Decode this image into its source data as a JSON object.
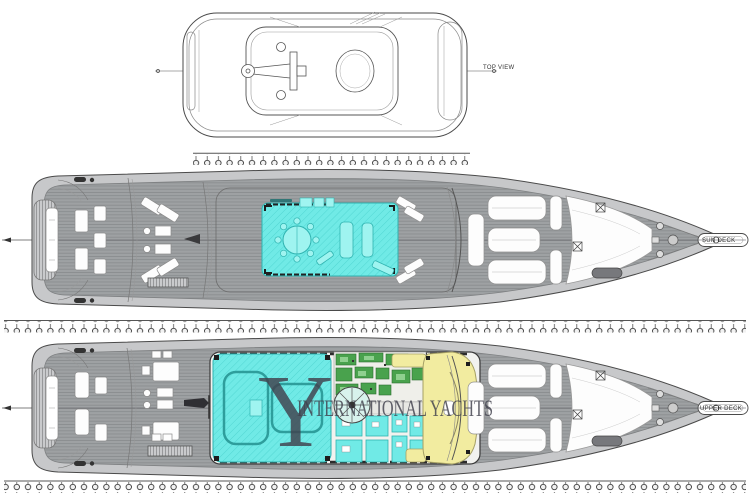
{
  "views": {
    "top": {
      "label": "TOP VIEW"
    },
    "sun_deck": {
      "label": "SUN DECK"
    },
    "upper_deck": {
      "label": "UPPER DECK"
    }
  },
  "watermark": {
    "monogram": "Y",
    "text": "INTERNATIONAL YACHTS"
  },
  "colors": {
    "highlight": "#70EAE6",
    "highlightStrong": "#9FF4F0",
    "highlightBorder": "#2FB3B0",
    "galleyGreen": "#49A24D",
    "galleyGreenLight": "#8FD08F",
    "bridgeYellow": "#F2ECA0",
    "bridgeYellowBorder": "#A6A065",
    "deckTeak": "#9EA1A3",
    "deckLine": "#85888A",
    "hullLight": "#C7C8CA",
    "outline": "#4A4A4A",
    "watermarkInk": "#41414D",
    "furniture": "#FDFDFD",
    "paper": "#FFFFFF"
  }
}
